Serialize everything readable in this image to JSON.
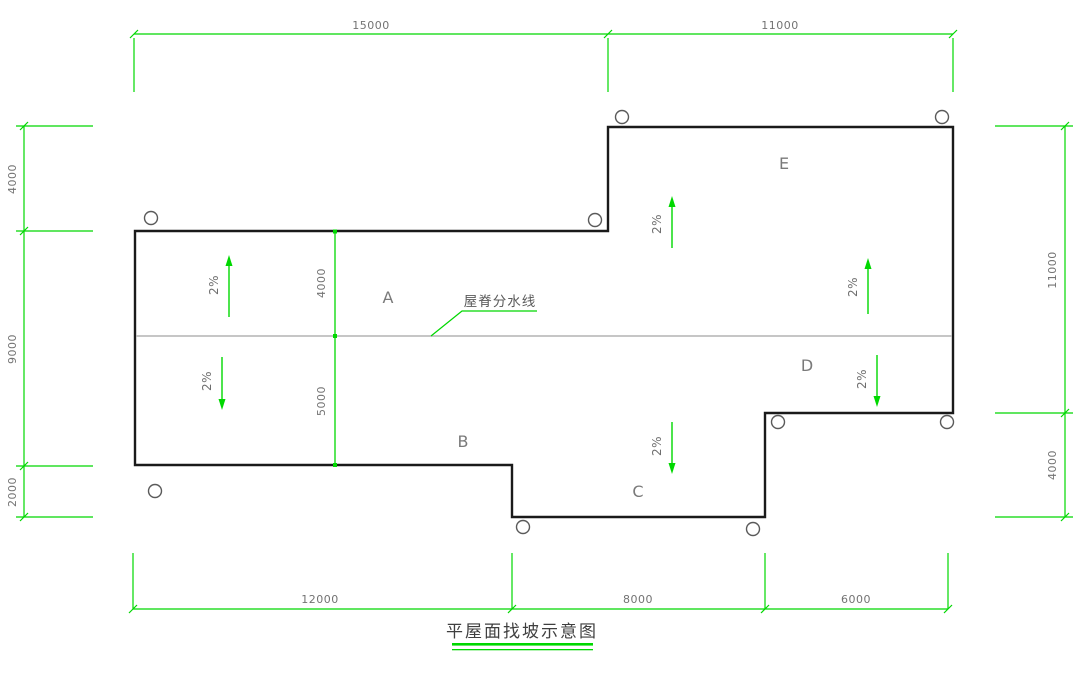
{
  "title": {
    "text": "平屋面找坡示意图"
  },
  "ridge_line": {
    "label": "屋脊分水线"
  },
  "regions": [
    {
      "label": "A"
    },
    {
      "label": "B"
    },
    {
      "label": "C"
    },
    {
      "label": "D"
    },
    {
      "label": "E"
    }
  ],
  "slopes": [
    {
      "label": "2%",
      "direction": "up"
    },
    {
      "label": "2%",
      "direction": "down"
    },
    {
      "label": "2%",
      "direction": "up"
    },
    {
      "label": "2%",
      "direction": "up"
    },
    {
      "label": "2%",
      "direction": "down"
    },
    {
      "label": "2%",
      "direction": "down"
    }
  ],
  "dimensions": {
    "top": [
      "15000",
      "11000"
    ],
    "bottom": [
      "12000",
      "8000",
      "6000"
    ],
    "left": [
      "4000",
      "9000",
      "2000"
    ],
    "right": [
      "11000",
      "4000"
    ],
    "interior": [
      "4000",
      "5000"
    ]
  },
  "markers": {
    "drain_circle_count": 9
  },
  "colors": {
    "dimension_green": "#00d800",
    "outline_black": "#1a1a1a",
    "ridge_gray": "#b4b4b4",
    "text_gray": "#737373"
  }
}
